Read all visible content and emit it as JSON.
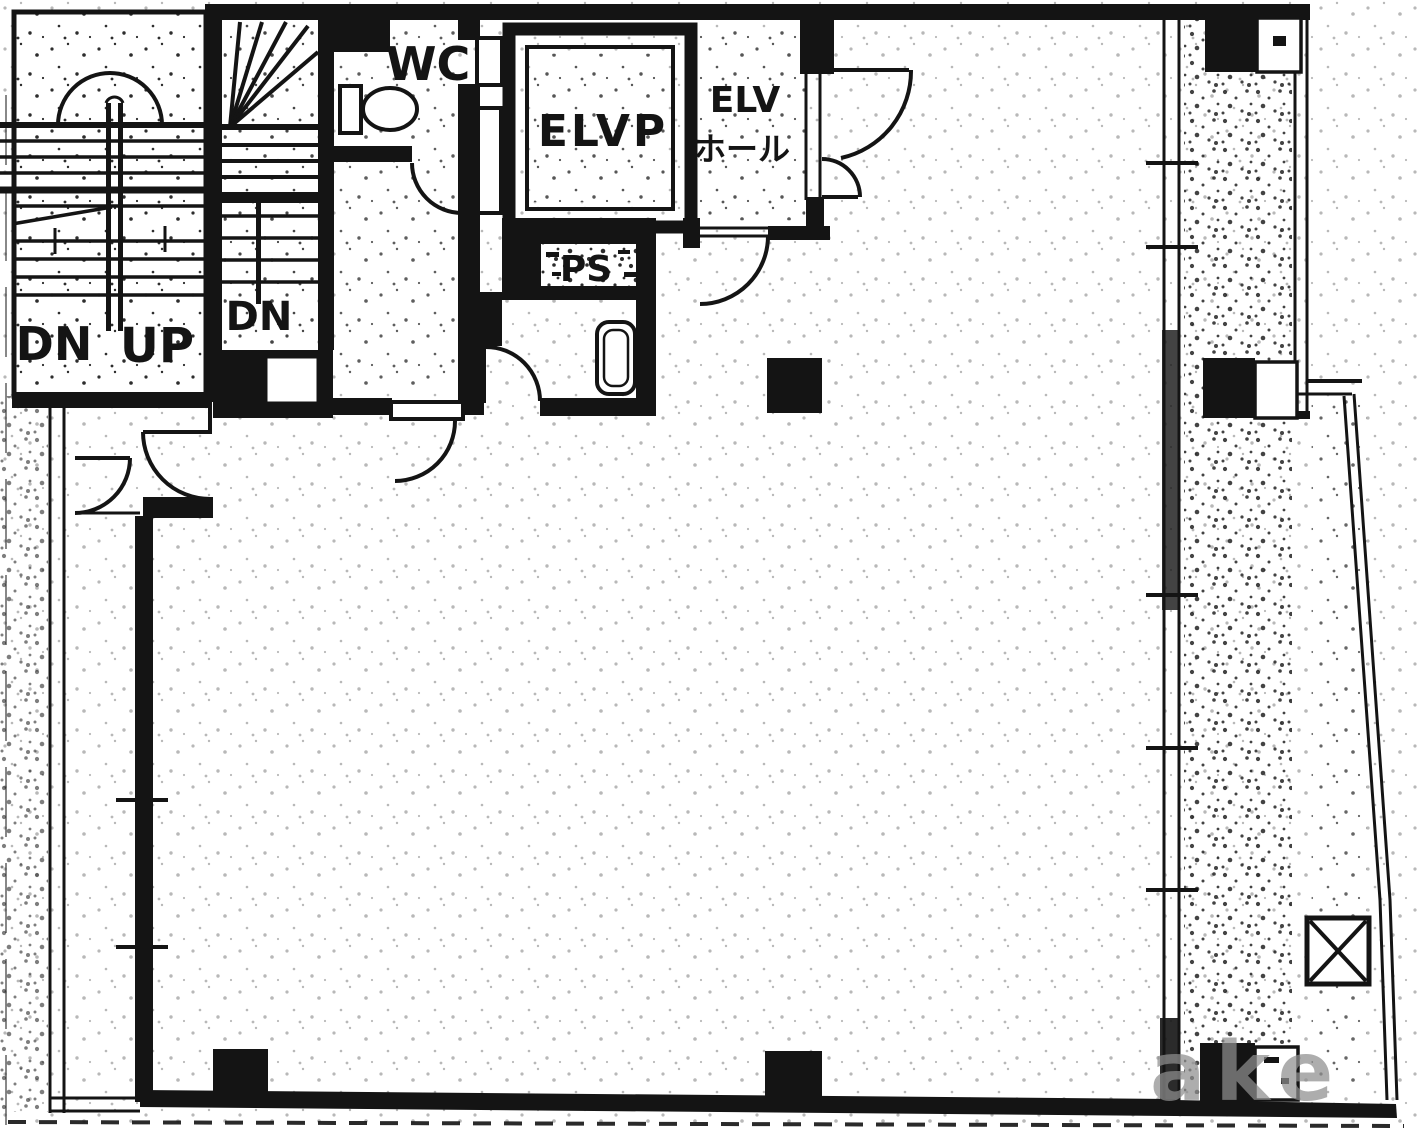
{
  "colors": {
    "ink": "#141414",
    "paper": "#ffffff",
    "watermark_gray": "#8e8e8e"
  },
  "labels": {
    "wc": "WC",
    "elvp": "ELVP",
    "elv": "ELV",
    "elv_hall": "ホール",
    "ps": "PS",
    "left_stair_dn": "DN",
    "left_stair_up": "UP",
    "winder_stair_dn": "DN"
  },
  "watermark_text": "ake",
  "icons": {
    "toilet": "toilet-icon",
    "basin": "basin-icon",
    "x_shaft": "x-marked-shaft-icon",
    "door_arcs": "door-swing-arc"
  }
}
